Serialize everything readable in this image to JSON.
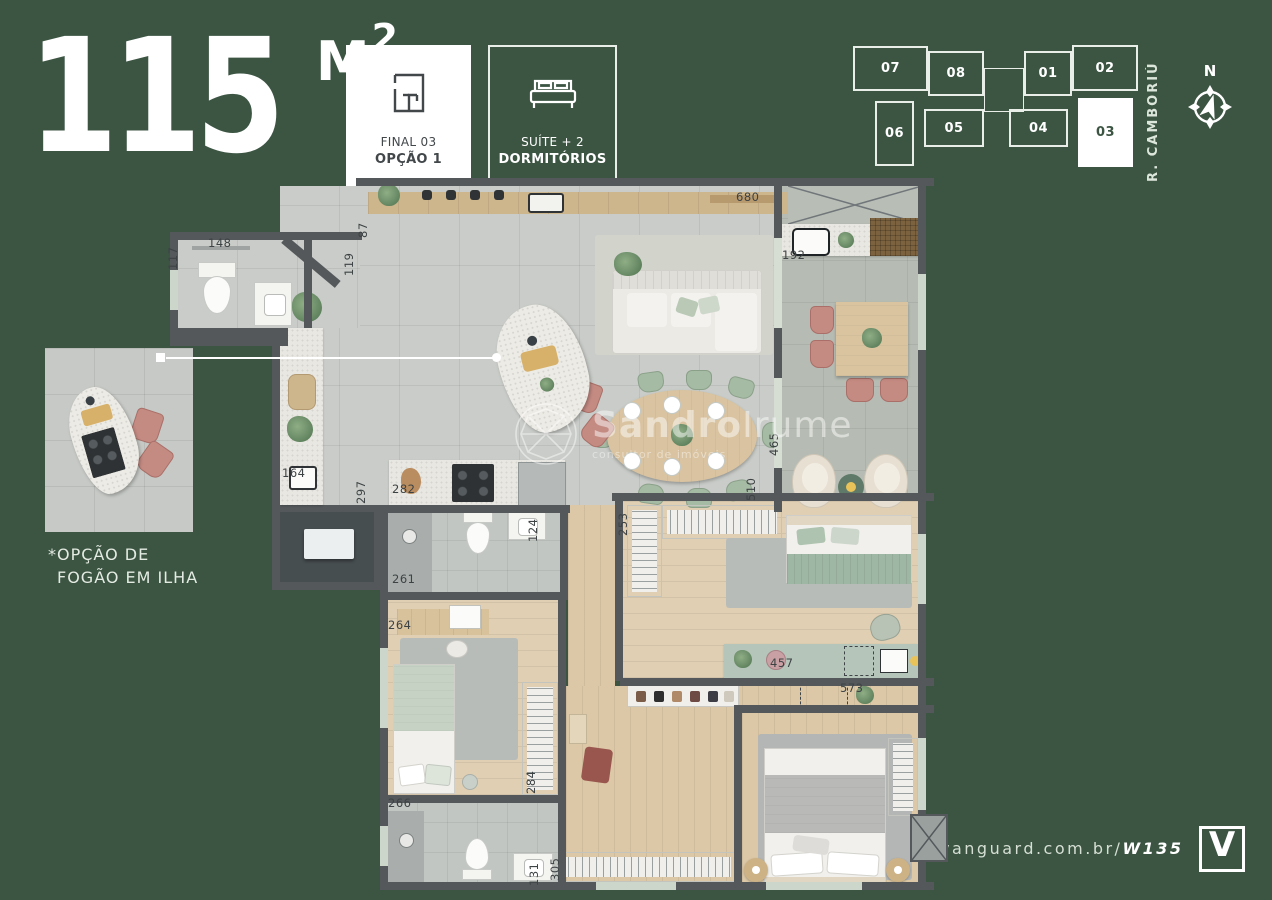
{
  "header": {
    "area_value": "115",
    "area_unit": "M",
    "area_sup": "2",
    "badge_option": {
      "line1": "FINAL 03",
      "line2": "OPÇÃO 1"
    },
    "badge_suite": {
      "line1": "SUÍTE + 2",
      "line2": "DORMITÓRIOS"
    }
  },
  "keyplan": {
    "street": "R. CAMBORIÚ",
    "north": "N",
    "units": [
      {
        "label": "07",
        "x": 8,
        "y": 8,
        "w": 75,
        "h": 45,
        "highlight": false
      },
      {
        "label": "08",
        "x": 83,
        "y": 13,
        "w": 56,
        "h": 45,
        "highlight": false
      },
      {
        "label": "01",
        "x": 179,
        "y": 13,
        "w": 48,
        "h": 45,
        "highlight": false
      },
      {
        "label": "02",
        "x": 227,
        "y": 7,
        "w": 66,
        "h": 46,
        "highlight": false
      },
      {
        "label": "06",
        "x": 30,
        "y": 63,
        "w": 39,
        "h": 65,
        "highlight": false
      },
      {
        "label": "05",
        "x": 79,
        "y": 71,
        "w": 60,
        "h": 38,
        "highlight": false
      },
      {
        "label": "04",
        "x": 164,
        "y": 71,
        "w": 59,
        "h": 38,
        "highlight": false
      },
      {
        "label": "03",
        "x": 233,
        "y": 60,
        "w": 55,
        "h": 69,
        "highlight": true
      }
    ]
  },
  "inset": {
    "caption_line1": "*OPÇÃO DE",
    "caption_line2": "FOGÃO EM ILHA"
  },
  "watermark": {
    "name_bold": "Sandro",
    "name_light": "Irume",
    "subtitle": "consultor de imóveis"
  },
  "footer": {
    "url_regular": "vanguard.com.br/",
    "url_bold": "W135",
    "logo_letter": "V"
  },
  "floorplan": {
    "dimensions": [
      {
        "t": "117",
        "x": 10,
        "y": 78,
        "r": 1
      },
      {
        "t": "148",
        "x": 38,
        "y": 58,
        "r": 0
      },
      {
        "t": "87",
        "x": 200,
        "y": 46,
        "r": 1
      },
      {
        "t": "119",
        "x": 186,
        "y": 84,
        "r": 1
      },
      {
        "t": "680",
        "x": 566,
        "y": 12,
        "r": 0
      },
      {
        "t": "192",
        "x": 612,
        "y": 70,
        "r": 0
      },
      {
        "t": "164",
        "x": 112,
        "y": 288,
        "r": 0
      },
      {
        "t": "297",
        "x": 198,
        "y": 312,
        "r": 1
      },
      {
        "t": "282",
        "x": 222,
        "y": 304,
        "r": 0
      },
      {
        "t": "124",
        "x": 370,
        "y": 350,
        "r": 1
      },
      {
        "t": "261",
        "x": 222,
        "y": 394,
        "r": 0
      },
      {
        "t": "264",
        "x": 218,
        "y": 440,
        "r": 0
      },
      {
        "t": "284",
        "x": 368,
        "y": 602,
        "r": 1
      },
      {
        "t": "266",
        "x": 218,
        "y": 618,
        "r": 0
      },
      {
        "t": "131",
        "x": 371,
        "y": 694,
        "r": 1
      },
      {
        "t": "305",
        "x": 392,
        "y": 689,
        "r": 1
      },
      {
        "t": "253",
        "x": 460,
        "y": 344,
        "r": 1
      },
      {
        "t": "457",
        "x": 600,
        "y": 478,
        "r": 0
      },
      {
        "t": "573",
        "x": 670,
        "y": 503,
        "r": 0
      },
      {
        "t": "465",
        "x": 611,
        "y": 264,
        "r": 1
      },
      {
        "t": "510",
        "x": 588,
        "y": 309,
        "r": 1
      }
    ]
  },
  "colors": {
    "background_green": "#3c5543",
    "wall_gray": "#54585a",
    "tile_floor": "#c9ccc8",
    "wood_floor": "#dcc8a6",
    "terrace_concrete": "#b6bcb3",
    "accent_pink": "#c48b83",
    "accent_green": "#a6bba4",
    "white": "#ffffff"
  }
}
